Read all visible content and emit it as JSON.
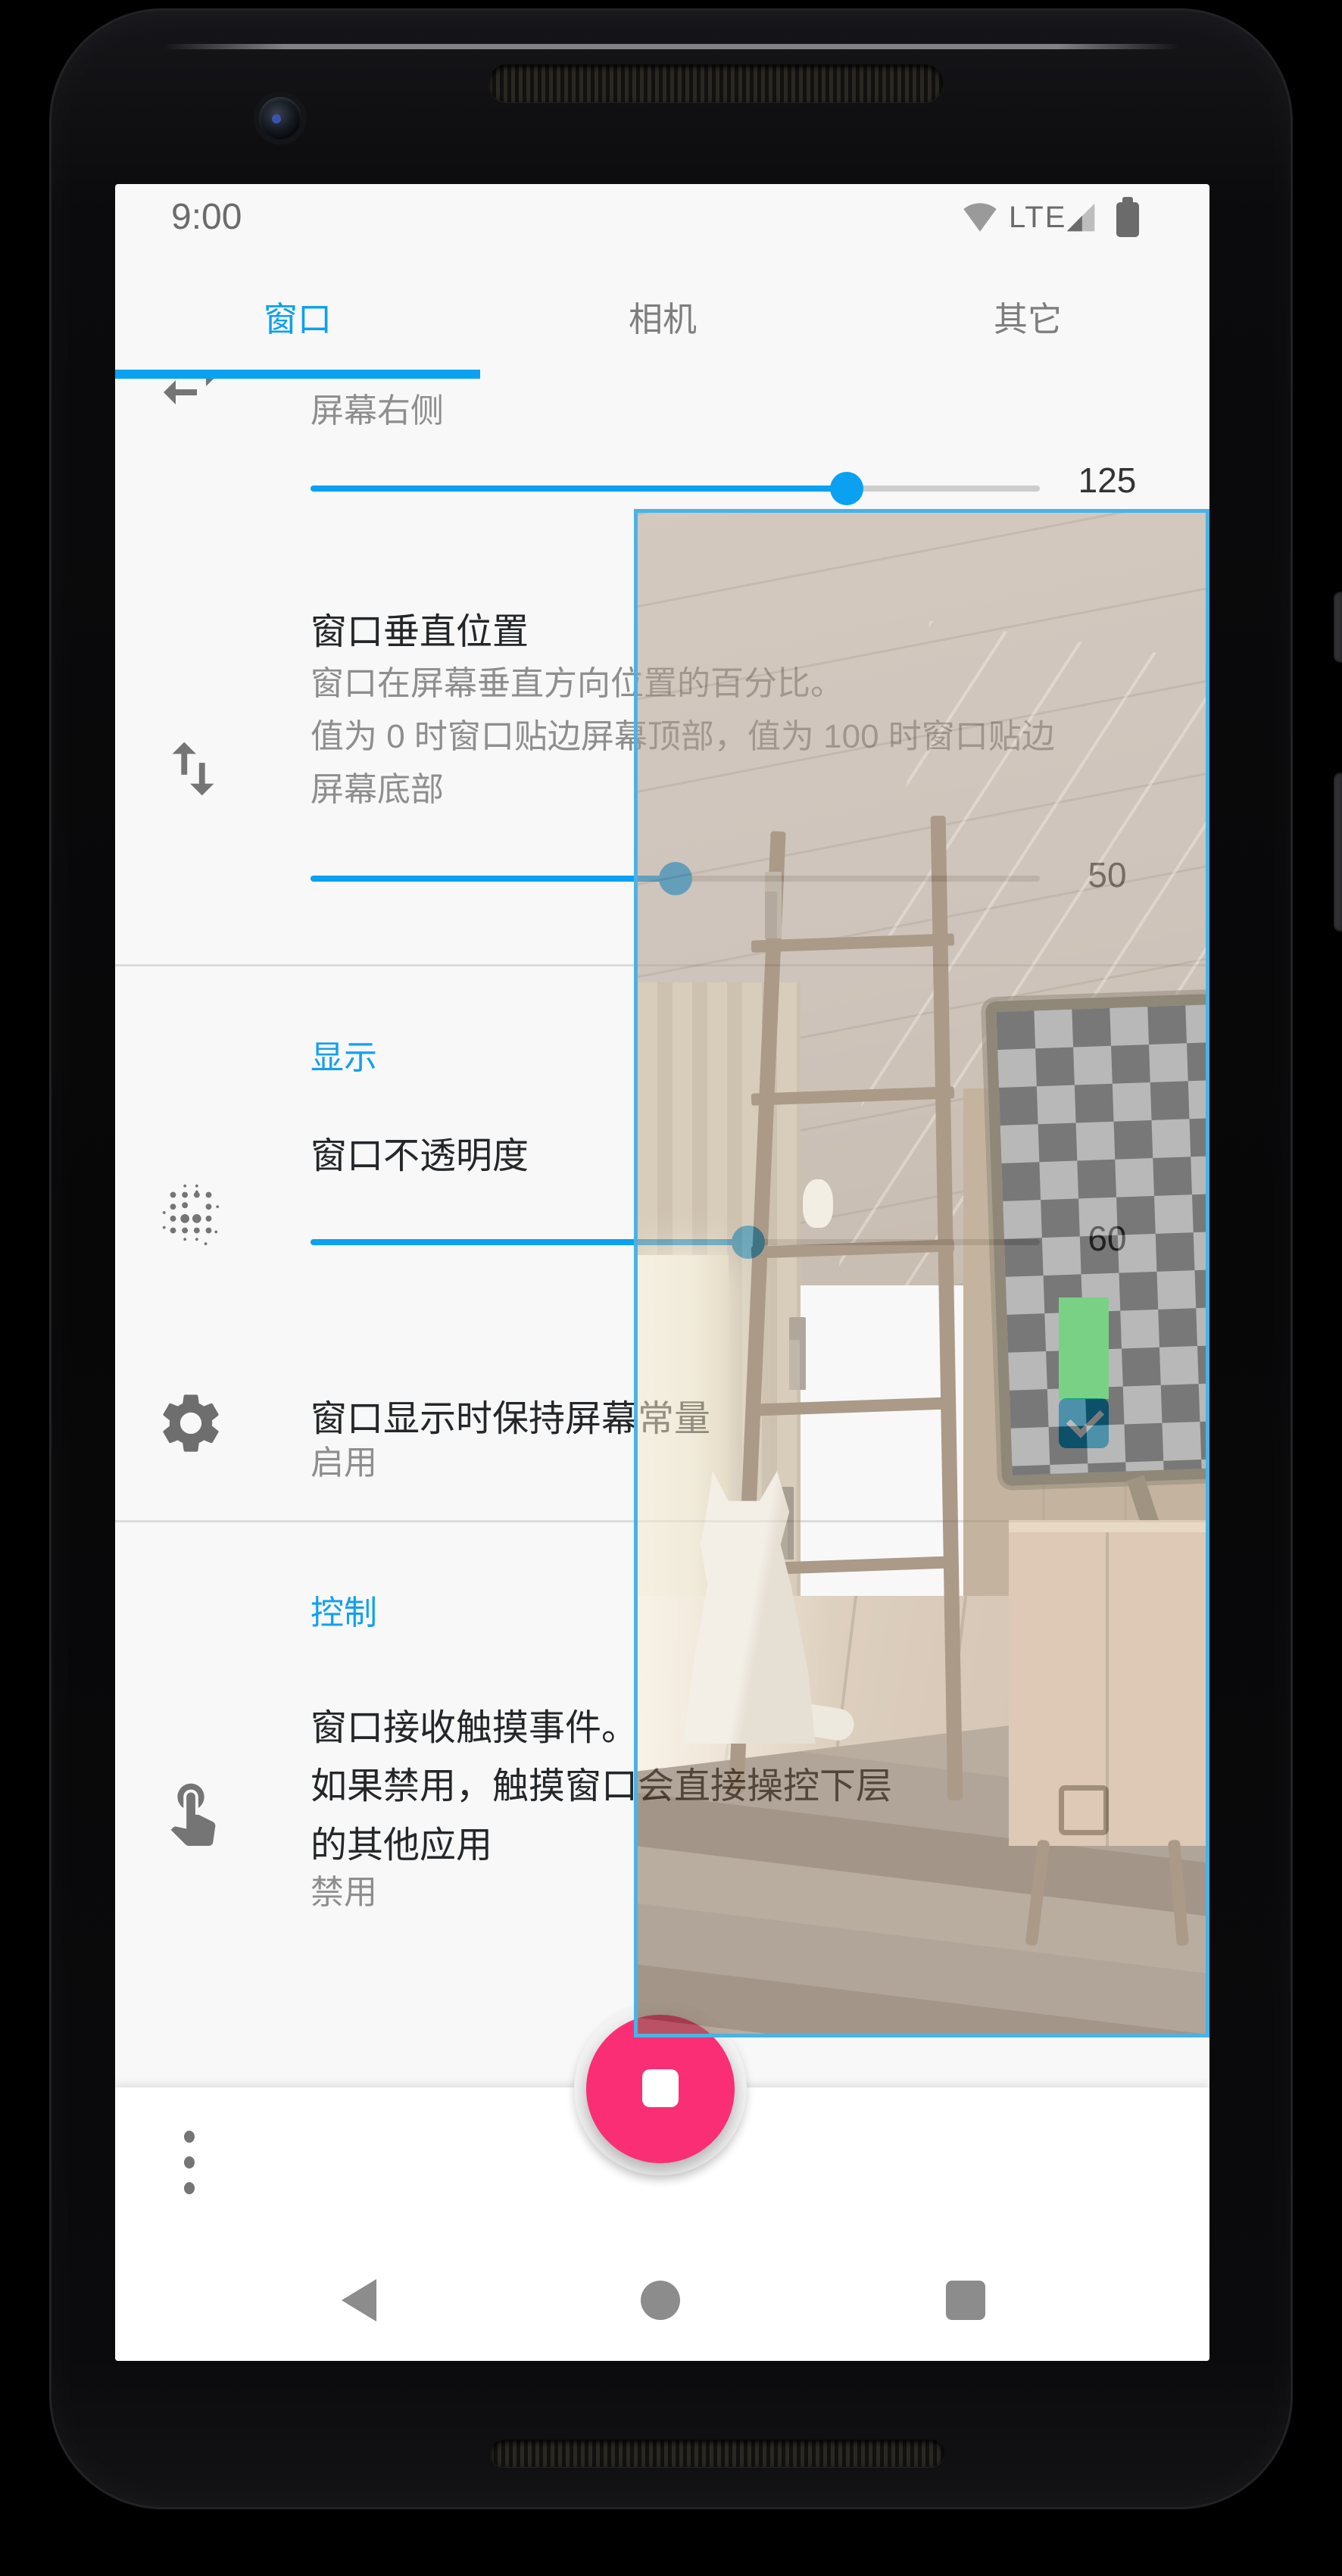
{
  "status_bar": {
    "time": "9:00",
    "network": "LTE"
  },
  "tabs": {
    "window": "窗口",
    "camera": "相机",
    "other": "其它"
  },
  "settings": {
    "horizontal_position": {
      "value_label": "屏幕右侧",
      "slider_value": "125",
      "slider_percent": 73.5
    },
    "vertical_position": {
      "title": "窗口垂直位置",
      "description_lines": [
        "窗口在屏幕垂直方向位置的百分比。",
        "值为 0 时窗口贴边屏幕顶部，值为 100 时窗口贴边",
        "屏幕底部"
      ],
      "slider_value": "50",
      "slider_percent": 50
    },
    "display_section": "显示",
    "opacity": {
      "title": "窗口不透明度",
      "slider_value": "60",
      "slider_percent": 60
    },
    "keep_screen_on": {
      "title": "窗口显示时保持屏幕常量",
      "status": "启用",
      "checked": true
    },
    "control_section": "控制",
    "touch_events": {
      "title_lines": [
        "窗口接收触摸事件。",
        "如果禁用，触摸窗口会直接操控下层",
        "的其他应用"
      ],
      "status": "禁用",
      "checked": false
    }
  },
  "colors": {
    "accent": "#0ba1f2",
    "section_header": "#12a0ef",
    "fab": "#fa2e75",
    "checkbox_checked": "#0a9ed6",
    "overlay_border": "#48b3e6",
    "status_icons": "#6b6b6b"
  }
}
